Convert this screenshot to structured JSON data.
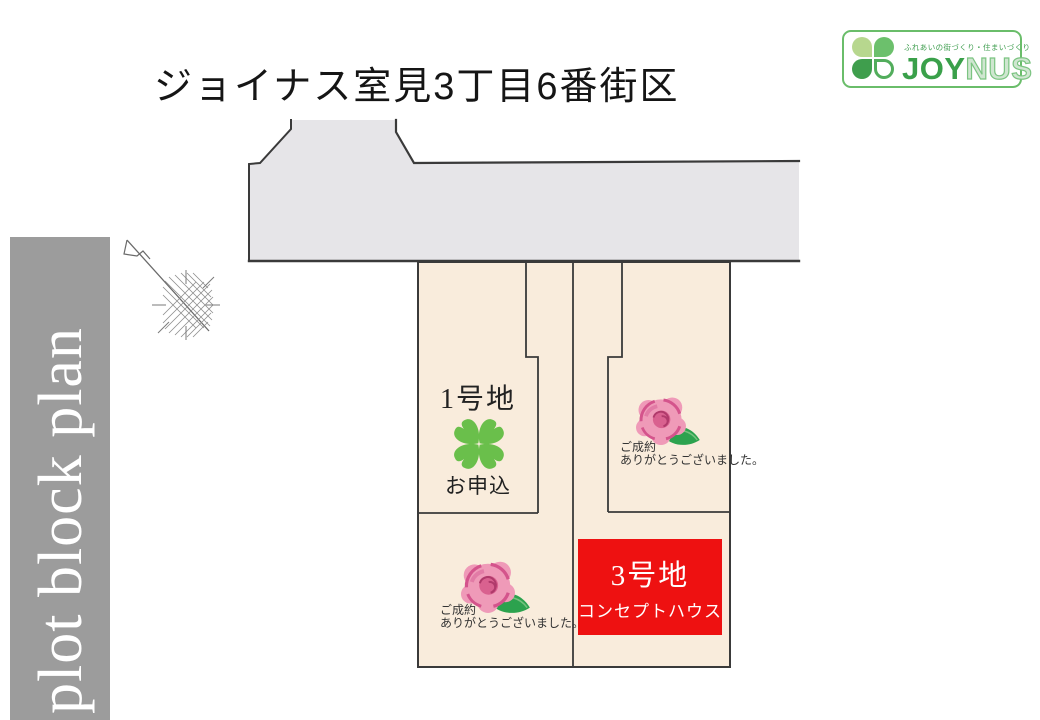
{
  "header": {
    "title": "ジョイナス室見3丁目6番街区"
  },
  "logo": {
    "tagline": "ふれあいの街づくり・住まいづくり",
    "brand_bold": "JOY",
    "brand_light": "NUS"
  },
  "sidebar": {
    "label": "plot block plan"
  },
  "plan": {
    "colors": {
      "road": "#e6e5e8",
      "lot_fill": "#f9ecdc",
      "boundary": "#3a3a3a",
      "highlight_red": "#ee1111",
      "clover_green": "#6abf4b",
      "rose_pink": "#ef9ab8",
      "rose_accent": "#d4548c",
      "leaf_green": "#2ca24e",
      "sidebar_gray": "#9c9c9c",
      "logo_green": "#3aa04a"
    },
    "lot1": {
      "name": "1号地",
      "status": "お申込"
    },
    "lot_upper_right": {
      "status_line1": "ご成約",
      "status_line2": "ありがとうございました。"
    },
    "lot_lower_left": {
      "status_line1": "ご成約",
      "status_line2": "ありがとうございました。"
    },
    "lot3": {
      "name": "3号地",
      "subtitle": "コンセプトハウス"
    }
  }
}
